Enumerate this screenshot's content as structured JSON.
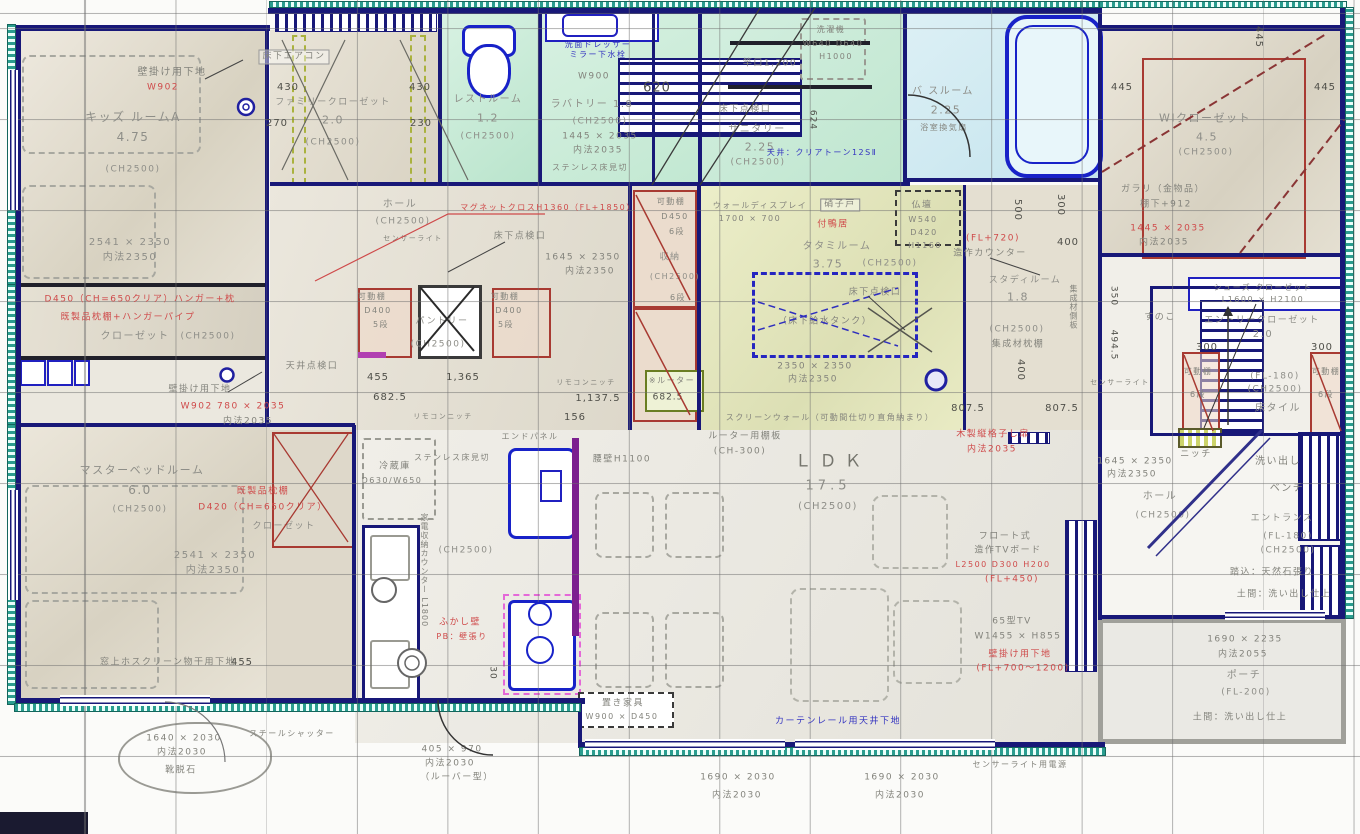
{
  "palette": {
    "wall": "#181878",
    "teal": "#2a9d8f",
    "red": "#cf4a4a",
    "blue": "#3434c0",
    "beige": "#e0dbcc",
    "mint": "#cdeada",
    "bath": "#cfe9f0",
    "tatami": "#e6e7c6",
    "purple": "#7c1f8f"
  },
  "rooms": {
    "kids": {
      "name": "キッズ ルームA",
      "size": "4.75",
      "ch": "(CH2500)",
      "dim": "2541 × 2350",
      "inner": "内法2350",
      "wall_note": "壁掛け用下地",
      "wall_code": "W902"
    },
    "kids_closet": {
      "red1": "D450（CH=650クリア）ハンガー+枕",
      "red2": "既製品枕棚+ハンガーパイプ",
      "name": "クローゼット",
      "ch": "(CH2500)"
    },
    "family_closet": {
      "name": "ファミリークローゼット",
      "size": "2.0",
      "ch": "(CH2500)",
      "aircon": "床下エアコン",
      "d430a": "430",
      "d430b": "430",
      "d270": "270",
      "d230": "230"
    },
    "rest": {
      "name": "レストルーム",
      "size": "1.2",
      "ch": "(CH2500)"
    },
    "lavatory": {
      "name": "ラバトリー 1.8",
      "ch": "(CH2500)",
      "dim": "1445 × 2035",
      "inner": "内法2035",
      "dresser1": "洗面ドレッサー",
      "dresser2": "ミラー下水栓",
      "w900": "W900",
      "d620": "620",
      "mikiri": "ステンレス床見切"
    },
    "sanitary": {
      "name": "サニタリー",
      "size": "2.25",
      "ch": "(CH2500)",
      "ceiling": "天井：クリアトーン12SⅡ",
      "pole": "竿口1,200",
      "hatch": "床下点検口",
      "washer1": "洗濯機",
      "washer2": "W640 D640",
      "washer3": "H1000",
      "d624": "624"
    },
    "bath": {
      "name": "バ スルーム",
      "size": "2.25",
      "fan": "浴室換気扇"
    },
    "wic": {
      "name": "WIクローゼット",
      "size": "4.5",
      "ch": "(CH2500)",
      "galari1": "ガラリ（金物品）",
      "galari2": "棚下+912",
      "dim": "1445 × 2035",
      "inner": "内法2035",
      "d445a": "445",
      "d445b": "445",
      "d445c": "445"
    },
    "hall": {
      "name": "ホール",
      "ch": "(CH2500)",
      "sensor": "センサーライト",
      "red_note": "マグネットクロスH1360（FL+1850）",
      "hatch": "床下点検口",
      "ceil_hatch": "天井点検口",
      "d455": "455",
      "d1365": "1,365",
      "d6825": "682.5",
      "remo1": "リモコンニッチ",
      "remo2": "リモコンニッチ",
      "d11375": "1,137.5",
      "d156": "156",
      "router": "※ルーター",
      "d6825b": "682.5",
      "dim": "1645 × 2350",
      "inner": "内法2350"
    },
    "pantry": {
      "name": "パントリー",
      "ch": "(CH2500)",
      "shelfL1": "可動棚",
      "shelfL2": "D400",
      "shelfL3": "5段",
      "shelfR1": "可動棚",
      "shelfR2": "D400",
      "shelfR3": "5段"
    },
    "storage": {
      "shelf1": "可動棚",
      "shelf2": "D450",
      "shelf3": "6段",
      "name": "収納",
      "ch": "(CH2500)",
      "dan": "6段"
    },
    "tatami": {
      "display1": "ウォールディスプレイ",
      "display2": "1700 × 700",
      "glass": "硝子戸",
      "kamoi": "付鴨居",
      "name": "タタミルーム",
      "size": "3.75",
      "ch": "(CH2500)",
      "butsudan": "仏壇",
      "bw": "W540",
      "bd": "D420",
      "bh": "H1160",
      "hatch": "床下点検口",
      "tank": "（床下給水タンク）",
      "dim": "2350 × 2350",
      "inner": "内法2350",
      "screen": "スクリーンウォール（可動間仕切り直角納まり）",
      "d8075a": "807.5",
      "d8075b": "807.5"
    },
    "study": {
      "counter": "造作カウンター",
      "fl": "(FL+720)",
      "name": "スタディルーム",
      "size": "1.8",
      "ch": "(CH2500)",
      "shelf": "集成材枕棚",
      "side": "集成材側板",
      "d400a": "400",
      "d400b": "400",
      "d500": "500",
      "d300": "300"
    },
    "ldk": {
      "name": "ＬＤＫ",
      "size": "17.5",
      "ch": "(CH2500)",
      "router1": "ルーター用棚板",
      "router2": "(CH-300)",
      "koshi": "腰壁H1100",
      "lattice1": "木製縦格子し扉",
      "lattice2": "内法2035",
      "tv1": "フロート式",
      "tv2": "造作TVボード",
      "tv3": "L2500 D300 H200",
      "tv4": "(FL+450)",
      "tv5": "65型TV",
      "tv6": "W1455 × H855",
      "tv7": "壁掛け用下地",
      "tv8": "(FL+700〜1200)"
    },
    "kitchen": {
      "fridge1": "冷蔵庫",
      "fridge2": "D630/W650",
      "mikiri": "ステンレス床見切",
      "end": "エンドパネル",
      "ch": "(CH2500)",
      "counter": "家電収納カウンター L1800",
      "fukashi1": "ふかし壁",
      "fukashi2": "PB：壁張り",
      "d30": "30"
    },
    "entry": {
      "shoes1": "シューズ クローゼット",
      "shoes2": "L1600 × H2100",
      "name": "エントリークローゼット",
      "size": "2.0",
      "d300a": "300",
      "d300b": "300",
      "shelfL": "可動棚",
      "shelfLd": "6段",
      "shelfR": "可動棚",
      "shelfRd": "6段",
      "fl": "(FL-180)",
      "ch": "(CH2500)",
      "tile": "床タイル",
      "sunoko": "すのこ",
      "d4945": "494.5",
      "d350": "350",
      "sensor": "センサーライト",
      "niche": "ニッチ"
    },
    "entry_hall": {
      "name": "ホール",
      "ch": "(CH2500)",
      "dim": "1645 × 2350",
      "inner": "内法2350"
    },
    "entrance": {
      "araidashi": "洗い出し",
      "bench": "ベンチ",
      "name": "エントランス",
      "fl": "(FL-180)",
      "ch": "(CH2500)",
      "fumikomi": "踏込：天然石張り",
      "doma": "土間：洗い出し仕上"
    },
    "porch": {
      "dim": "1690 × 2235",
      "inner": "内法2055",
      "name": "ポーチ",
      "fl": "(FL-200)",
      "doma": "土間：洗い出し仕上"
    },
    "master": {
      "name": "マスターベッドルーム",
      "size": "6.0",
      "ch": "(CH2500)",
      "dim": "2541 × 2350",
      "inner": "内法2350",
      "wall_note": "壁掛け用下地",
      "win_red": "W902 780 × 2035",
      "win_inner": "内法2035"
    },
    "master_closet": {
      "red1": "既製品枕棚",
      "red2": "D420（CH=650クリア）",
      "name": "クローゼット"
    }
  },
  "bottom": {
    "hosu": "窓上ホスクリーン物干用下地",
    "d455": "455",
    "shutter": "スチールシャッター",
    "dim1": "1640 × 2030",
    "inner1": "内法2030",
    "stone": "靴脱石",
    "dim2": "405 × 970",
    "inner2": "内法2030",
    "louver": "（ルーバー型）",
    "furniture1": "置き家具",
    "furniture2": "W900 × D450",
    "curtain": "カーテンレール用天井下地",
    "dim3": "1690 × 2030",
    "inner3": "内法2030",
    "dim4": "1690 × 2030",
    "inner4": "内法2030",
    "power": "センサーライト用電源"
  }
}
